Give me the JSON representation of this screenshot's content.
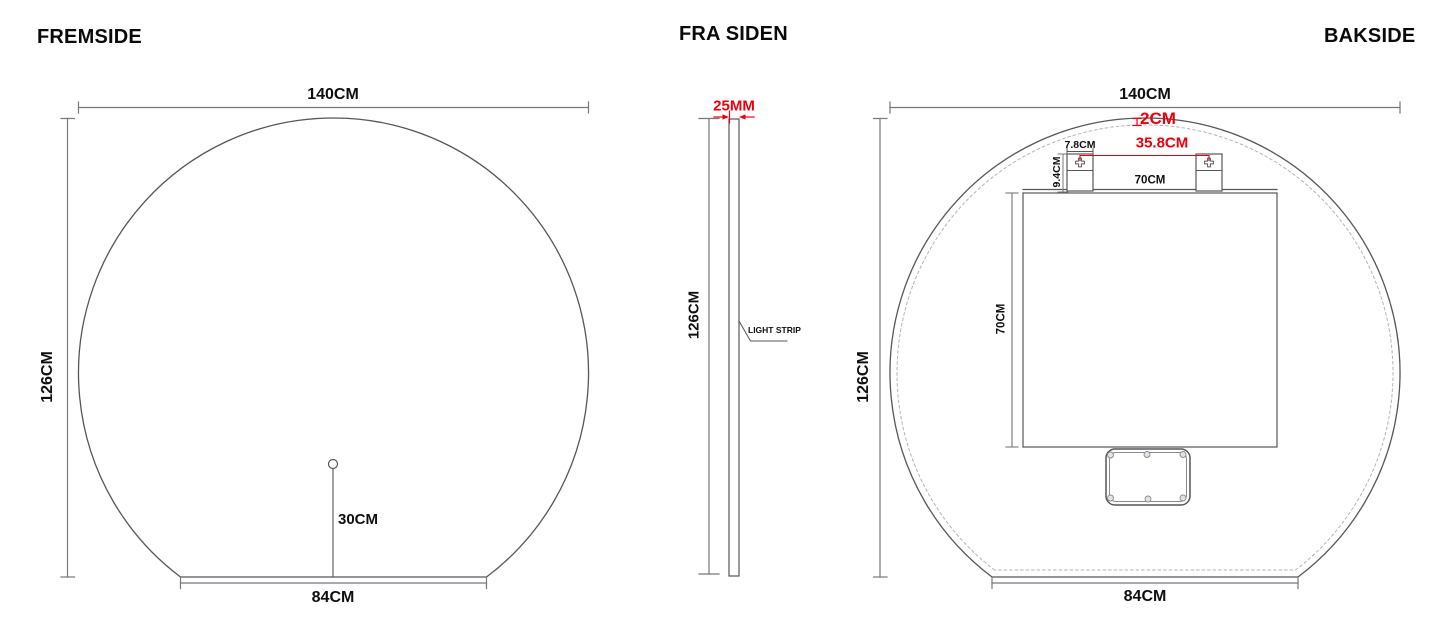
{
  "document": {
    "background": "#ffffff",
    "colors": {
      "outline": "#55565a",
      "dimension_line": "#77787b",
      "dashed_led_line": "#b4b4b6",
      "accent_red": "#e8000d",
      "text": "#0f0f10"
    }
  },
  "views": {
    "fremside": {
      "title": "FREMSIDE",
      "width": "140CM",
      "height": "126CM",
      "bottom_width": "84CM",
      "sensor_height": "30CM"
    },
    "fra_siden": {
      "title": "FRA SIDEN",
      "thickness": "25MM",
      "height": "126CM",
      "light_strip": "LIGHT STRIP"
    },
    "bakside": {
      "title": "BAKSIDE",
      "width": "140CM",
      "height": "126CM",
      "bottom_width": "84CM",
      "led_inset": "2CM",
      "bracket_width": "7.8CM",
      "bracket_spacing": "35.8CM",
      "bracket_height": "9.4CM",
      "panel_width": "70CM",
      "panel_height": "70CM"
    }
  }
}
